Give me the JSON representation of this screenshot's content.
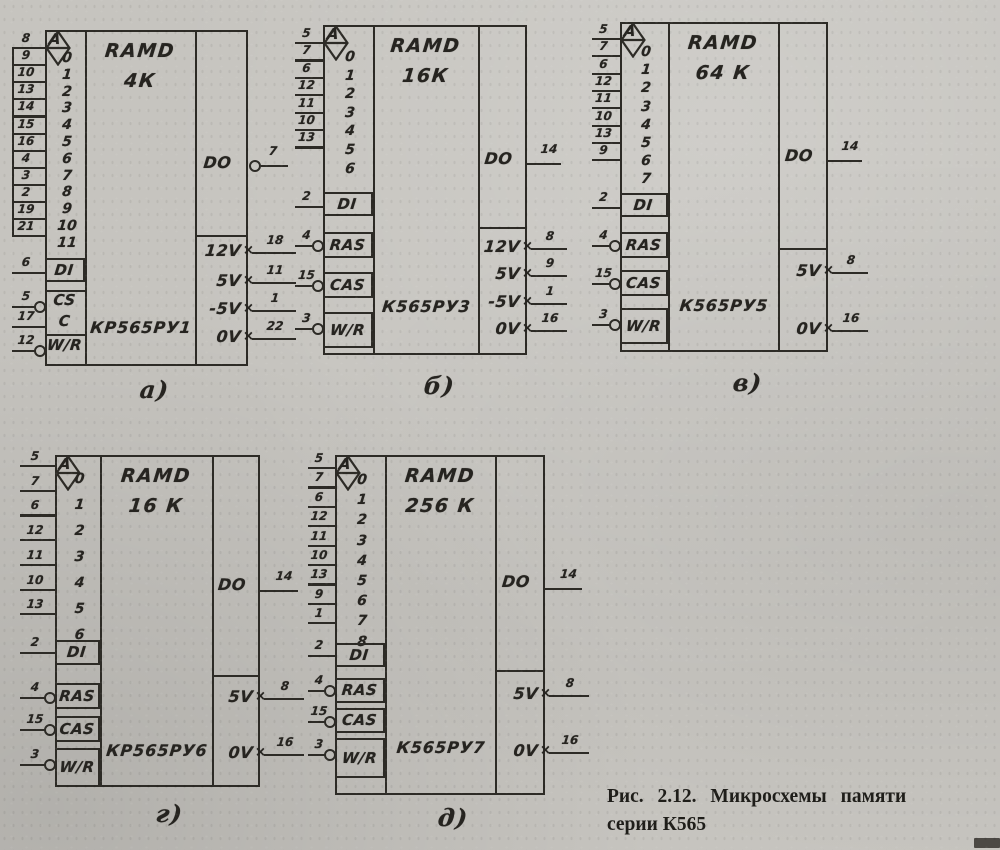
{
  "icons": {
    "tristate_output_symbol": "tristate-diamond",
    "power_input_marker": "×"
  },
  "chips": [
    {
      "sub_label": "а)",
      "type_label": "RAMD",
      "capacity": "4К",
      "part_number": "КР565РУ1",
      "address_header": "A",
      "address_pins": [
        {
          "pin": "8",
          "index": "0"
        },
        {
          "pin": "9",
          "index": "1"
        },
        {
          "pin": "10",
          "index": "2"
        },
        {
          "pin": "13",
          "index": "3"
        },
        {
          "pin": "14",
          "index": "4"
        },
        {
          "pin": "15",
          "index": "5"
        },
        {
          "pin": "16",
          "index": "6"
        },
        {
          "pin": "4",
          "index": "7"
        },
        {
          "pin": "3",
          "index": "8"
        },
        {
          "pin": "2",
          "index": "9"
        },
        {
          "pin": "19",
          "index": "10"
        },
        {
          "pin": "21",
          "index": "11"
        }
      ],
      "data_input": {
        "label": "DI",
        "pin": "6"
      },
      "controls": [
        {
          "label": "CS",
          "pin": "5",
          "inverted": true
        },
        {
          "label": "C",
          "pin": "17",
          "inverted": false
        },
        {
          "label": "W/R",
          "pin": "12",
          "inverted": true
        }
      ],
      "output": {
        "label": "DO",
        "pin": "7",
        "inverted": true
      },
      "power": [
        {
          "label": "12V",
          "pin": "18"
        },
        {
          "label": "5V",
          "pin": "11"
        },
        {
          "label": "-5V",
          "pin": "1"
        },
        {
          "label": "0V",
          "pin": "22"
        }
      ]
    },
    {
      "sub_label": "б)",
      "type_label": "RAMD",
      "capacity": "16К",
      "part_number": "К565РУ3",
      "address_header": "A",
      "address_pins": [
        {
          "pin": "5",
          "index": "0"
        },
        {
          "pin": "7",
          "index": "1"
        },
        {
          "pin": "6",
          "index": "2"
        },
        {
          "pin": "12",
          "index": "3"
        },
        {
          "pin": "11",
          "index": "4"
        },
        {
          "pin": "10",
          "index": "5"
        },
        {
          "pin": "13",
          "index": "6"
        }
      ],
      "data_input": {
        "label": "DI",
        "pin": "2"
      },
      "controls": [
        {
          "label": "RAS",
          "pin": "4",
          "inverted": true
        },
        {
          "label": "CAS",
          "pin": "15",
          "inverted": true
        },
        {
          "label": "W/R",
          "pin": "3",
          "inverted": true
        }
      ],
      "output": {
        "label": "DO",
        "pin": "14",
        "inverted": false
      },
      "power": [
        {
          "label": "12V",
          "pin": "8"
        },
        {
          "label": "5V",
          "pin": "9"
        },
        {
          "label": "-5V",
          "pin": "1"
        },
        {
          "label": "0V",
          "pin": "16"
        }
      ]
    },
    {
      "sub_label": "в)",
      "type_label": "RAMD",
      "capacity": "64 К",
      "part_number": "К565РУ5",
      "address_header": "A",
      "address_pins": [
        {
          "pin": "5",
          "index": "0"
        },
        {
          "pin": "7",
          "index": "1"
        },
        {
          "pin": "6",
          "index": "2"
        },
        {
          "pin": "12",
          "index": "3"
        },
        {
          "pin": "11",
          "index": "4"
        },
        {
          "pin": "10",
          "index": "5"
        },
        {
          "pin": "13",
          "index": "6"
        },
        {
          "pin": "9",
          "index": "7"
        }
      ],
      "data_input": {
        "label": "DI",
        "pin": "2"
      },
      "controls": [
        {
          "label": "RAS",
          "pin": "4",
          "inverted": true
        },
        {
          "label": "CAS",
          "pin": "15",
          "inverted": true
        },
        {
          "label": "W/R",
          "pin": "3",
          "inverted": true
        }
      ],
      "output": {
        "label": "DO",
        "pin": "14",
        "inverted": false
      },
      "power": [
        {
          "label": "5V",
          "pin": "8"
        },
        {
          "label": "0V",
          "pin": "16"
        }
      ]
    },
    {
      "sub_label": "г)",
      "type_label": "RAMD",
      "capacity": "16 К",
      "part_number": "КР565РУ6",
      "address_header": "A",
      "address_pins": [
        {
          "pin": "5",
          "index": "0"
        },
        {
          "pin": "7",
          "index": "1"
        },
        {
          "pin": "6",
          "index": "2"
        },
        {
          "pin": "12",
          "index": "3"
        },
        {
          "pin": "11",
          "index": "4"
        },
        {
          "pin": "10",
          "index": "5"
        },
        {
          "pin": "13",
          "index": "6"
        }
      ],
      "data_input": {
        "label": "DI",
        "pin": "2"
      },
      "controls": [
        {
          "label": "RAS",
          "pin": "4",
          "inverted": true
        },
        {
          "label": "CAS",
          "pin": "15",
          "inverted": true
        },
        {
          "label": "W/R",
          "pin": "3",
          "inverted": true
        }
      ],
      "output": {
        "label": "DO",
        "pin": "14",
        "inverted": false
      },
      "power": [
        {
          "label": "5V",
          "pin": "8"
        },
        {
          "label": "0V",
          "pin": "16"
        }
      ]
    },
    {
      "sub_label": "д)",
      "type_label": "RAMD",
      "capacity": "256 К",
      "part_number": "К565РУ7",
      "address_header": "A",
      "address_pins": [
        {
          "pin": "5",
          "index": "0"
        },
        {
          "pin": "7",
          "index": "1"
        },
        {
          "pin": "6",
          "index": "2"
        },
        {
          "pin": "12",
          "index": "3"
        },
        {
          "pin": "11",
          "index": "4"
        },
        {
          "pin": "10",
          "index": "5"
        },
        {
          "pin": "13",
          "index": "6"
        },
        {
          "pin": "9",
          "index": "7"
        },
        {
          "pin": "1",
          "index": "8"
        }
      ],
      "data_input": {
        "label": "DI",
        "pin": "2"
      },
      "controls": [
        {
          "label": "RAS",
          "pin": "4",
          "inverted": true
        },
        {
          "label": "CAS",
          "pin": "15",
          "inverted": true
        },
        {
          "label": "W/R",
          "pin": "3",
          "inverted": true
        }
      ],
      "output": {
        "label": "DO",
        "pin": "14",
        "inverted": false
      },
      "power": [
        {
          "label": "5V",
          "pin": "8"
        },
        {
          "label": "0V",
          "pin": "16"
        }
      ]
    }
  ],
  "caption": {
    "line1": "Рис. 2.12. Микросхемы памяти",
    "line2": "серии К565"
  }
}
